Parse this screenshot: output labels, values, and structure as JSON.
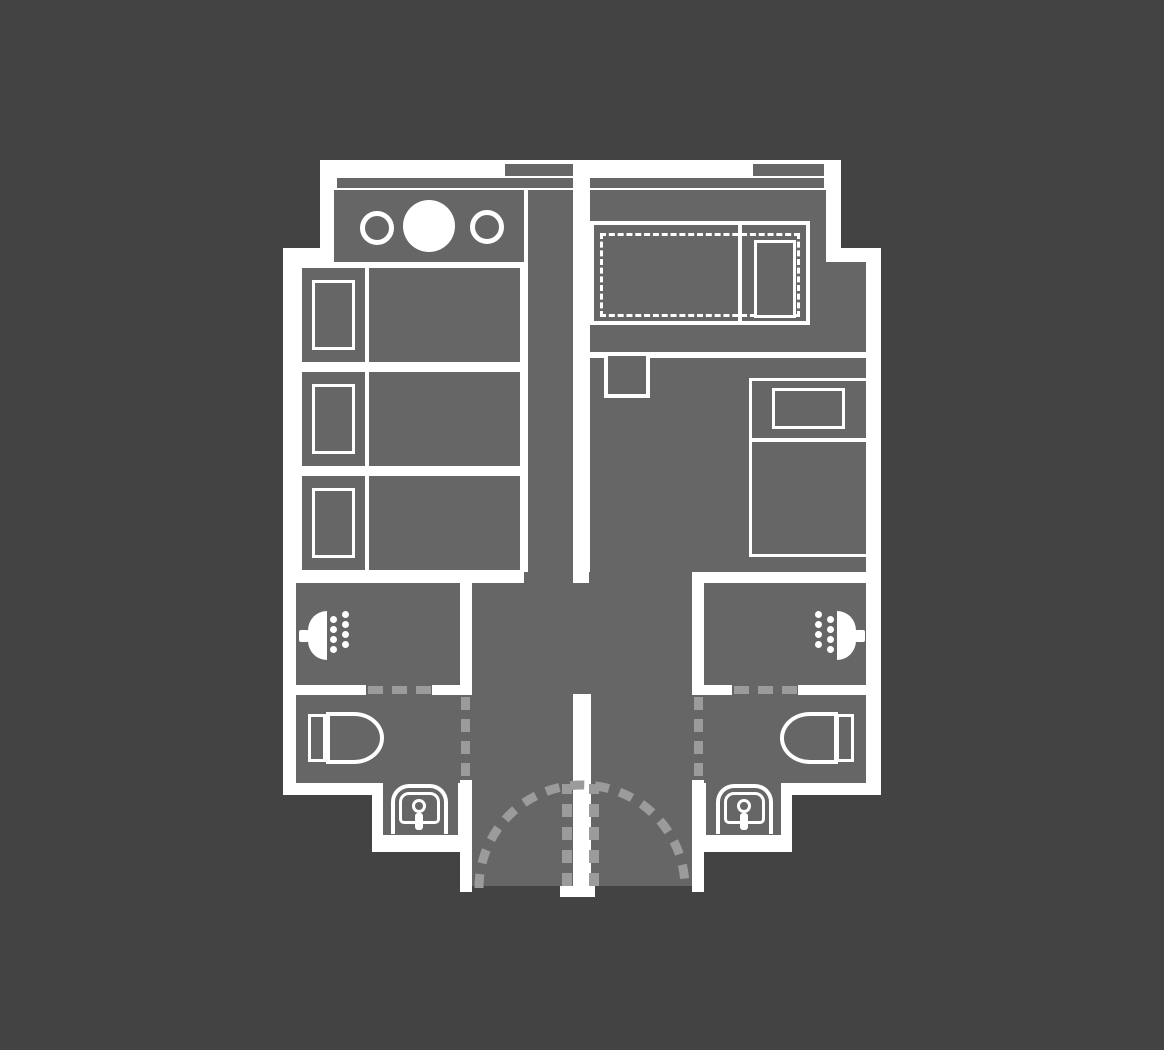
{
  "page": {
    "title": "Twin suite apartment floor plan"
  },
  "colors": {
    "background": "#434343",
    "floor": "#666666",
    "wall": "#ffffff",
    "marking": "#9b9b9b"
  },
  "plan": {
    "left_unit": {
      "kitchenette": {
        "hob_burners": 2,
        "kitchen_sink_basins": 1,
        "counter": 1
      },
      "bedroom": {
        "single_beds": 3,
        "pillows": 3
      },
      "bathroom": {
        "showers": 1,
        "toilets": 1,
        "washbasins": 1,
        "sliding_door_markers": 3,
        "doorway_markers": 4
      },
      "windows": 2
    },
    "right_unit": {
      "living_area": {
        "fold_out_beds": 1,
        "pillows": 1,
        "closets": 1
      },
      "sleeping_area": {
        "double_beds": 1,
        "pillows": 1
      },
      "bathroom": {
        "showers": 1,
        "toilets": 1,
        "washbasins": 1,
        "sliding_door_markers": 3,
        "doorway_markers": 4
      },
      "windows": 2
    },
    "entry": {
      "entry_doors": 2,
      "door_swing_arcs": 1,
      "door_panel_markers": 2
    }
  },
  "icons": [
    "hob-burner-icon",
    "kitchen-sink-icon",
    "shower-icon",
    "water-drop-icon",
    "toilet-icon",
    "washbasin-icon",
    "bed",
    "fold-out-bed",
    "door-swing-arc",
    "window"
  ]
}
